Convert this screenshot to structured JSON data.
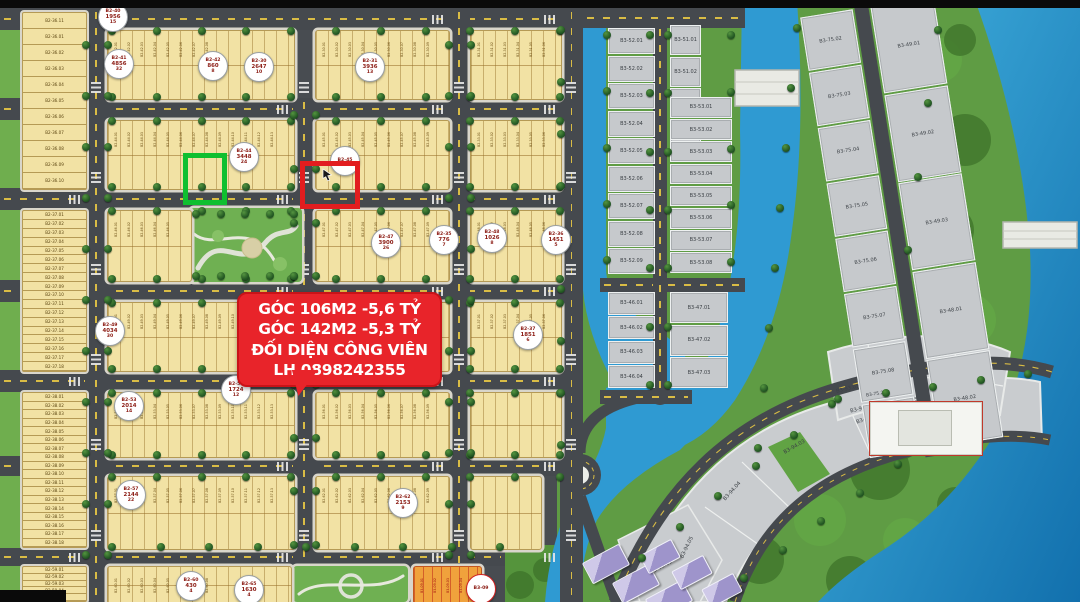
{
  "annotation": {
    "lines": [
      "GÓC 106M2 -5,6 TỶ",
      "GÓC 142M2 -5,3 TỶ",
      "ĐỐI DIỆN CÔNG VIÊN",
      "LH 0898242355"
    ],
    "bg_color": "#e8242a",
    "text_color": "#ffffff"
  },
  "highlights": {
    "green": {
      "color": "#0fbf30",
      "plots": [
        "B2-44.13",
        "B2-44.14"
      ]
    },
    "red": {
      "color": "#e21d1f",
      "plots": [
        "B2-45.08",
        "B2-45.09"
      ]
    }
  },
  "badges": [
    {
      "code": "B2-40",
      "area": "1956",
      "lots": "15"
    },
    {
      "code": "B2-41",
      "area": "4856",
      "lots": "32"
    },
    {
      "code": "B2-42",
      "area": "860",
      "lots": "8"
    },
    {
      "code": "B2-30",
      "area": "2647",
      "lots": "10"
    },
    {
      "code": "B2-31",
      "area": "3936",
      "lots": "13"
    },
    {
      "code": "B2-44",
      "area": "3448",
      "lots": "24"
    },
    {
      "code": "B2-45",
      "area": "",
      "lots": ""
    },
    {
      "code": "B2-47",
      "area": "3900",
      "lots": "26"
    },
    {
      "code": "B2-35",
      "area": "776",
      "lots": "7"
    },
    {
      "code": "B2-48",
      "area": "1026",
      "lots": "8"
    },
    {
      "code": "B2-36",
      "area": "1451",
      "lots": "5"
    },
    {
      "code": "B2-49",
      "area": "4034",
      "lots": "30"
    },
    {
      "code": "B2-37",
      "area": "1851",
      "lots": "6"
    },
    {
      "code": "B2-53",
      "area": "2014",
      "lots": "14"
    },
    {
      "code": "B2-56",
      "area": "1724",
      "lots": "12"
    },
    {
      "code": "B2-57",
      "area": "2144",
      "lots": "22"
    },
    {
      "code": "B2-62",
      "area": "2153",
      "lots": "9"
    },
    {
      "code": "B2-60",
      "area": "430",
      "lots": "4"
    },
    {
      "code": "B2-65",
      "area": "1630",
      "lots": "4"
    },
    {
      "code": "B3-09",
      "area": "",
      "lots": ""
    }
  ],
  "left_columns": [
    {
      "name": "B2-36",
      "labels": [
        "B2-36.11",
        "B2-36.01",
        "B2-36.02",
        "B2-36.03",
        "B2-36.04",
        "B2-36.05",
        "B2-36.06",
        "B2-36.07",
        "B2-36.08",
        "B2-36.09",
        "B2-36.10"
      ]
    },
    {
      "name": "B2-37",
      "prefix": "B2-37",
      "from": 1,
      "to": 18
    },
    {
      "name": "B2-38",
      "prefix": "B2-38",
      "from": 1,
      "to": 18
    },
    {
      "name": "B2-59",
      "prefix": "B2-59",
      "from": 1,
      "to": 5
    }
  ],
  "blocks": [
    {
      "prefix": "B2-42",
      "lots": 8
    },
    {
      "prefix": "B2-30",
      "lots": 10
    },
    {
      "prefix": "B2-31",
      "lots": 13
    },
    {
      "prefix": "B2-44",
      "lots": 24
    },
    {
      "prefix": "B2-45",
      "lots": 12
    },
    {
      "prefix": "B2-33",
      "lots": 15
    },
    {
      "prefix": "B2-46",
      "lots": 16
    },
    {
      "prefix": "B2-47",
      "lots": 26
    },
    {
      "prefix": "B2-48",
      "lots": 8
    },
    {
      "prefix": "B2-49",
      "lots": 30
    },
    {
      "prefix": null,
      "lots": 0
    },
    {
      "prefix": "B2-37",
      "lots": 6
    },
    {
      "prefix": "B2-53",
      "lots": 14
    },
    {
      "prefix": "B2-56",
      "lots": 12
    },
    {
      "prefix": null,
      "lots": 0
    },
    {
      "prefix": "B2-57",
      "lots": 22
    },
    {
      "prefix": "B2-62",
      "lots": 9
    },
    {
      "prefix": null,
      "lots": 0
    },
    {
      "prefix": "B2-60",
      "lots": 8
    },
    {
      "prefix": "B3-09",
      "lots": 6
    }
  ],
  "gray_groups": [
    {
      "name": "B3-52",
      "prefix": "B3-52",
      "from": 1,
      "to": 9
    },
    {
      "name": "B3-46",
      "prefix": "B3-46",
      "from": 1,
      "to": 4
    },
    {
      "name": "B3-51",
      "prefix": "B3-51",
      "from": 1,
      "to": 4
    },
    {
      "name": "B3-53",
      "prefix": "B3-53",
      "from": 1,
      "to": 8
    },
    {
      "name": "B3-47",
      "prefix": "B3-47",
      "from": 1,
      "to": 3
    },
    {
      "name": "B3-75",
      "prefix": "B3-75",
      "from": 2,
      "to": 9
    },
    {
      "name": "B3-49",
      "prefix": "B3-49",
      "from": 1,
      "to": 3
    },
    {
      "name": "B3-48",
      "prefix": "B3-48",
      "from": 1,
      "to": 2
    }
  ],
  "crescent_labels": {
    "b393": [
      "B3-93.01",
      "B3-93.02",
      "B3-93.03",
      "B3-93.04",
      "B3-93.05"
    ],
    "b394": [
      "B3-94.01",
      "B3-94.02",
      "B3-94.03",
      "B3-94.04",
      "B3-94.05"
    ],
    "b395": [
      "B3-95.01"
    ],
    "extra": "B3-75.24"
  },
  "colors": {
    "plot_yellow": "#f2e2a4",
    "plot_gray": "#c6c9cc",
    "plot_orange": "#f0a23c",
    "road": "#45494e",
    "lane_dash": "#d9bc45",
    "water": "#2f9ad2",
    "water_deep": "#1270ad",
    "green": "#5f9c44",
    "forest": "#3d7329",
    "annotation_red": "#e8242a",
    "badge_text": "#8b1a12",
    "highlight_green": "#0fbf30",
    "highlight_red": "#e21d1f"
  }
}
